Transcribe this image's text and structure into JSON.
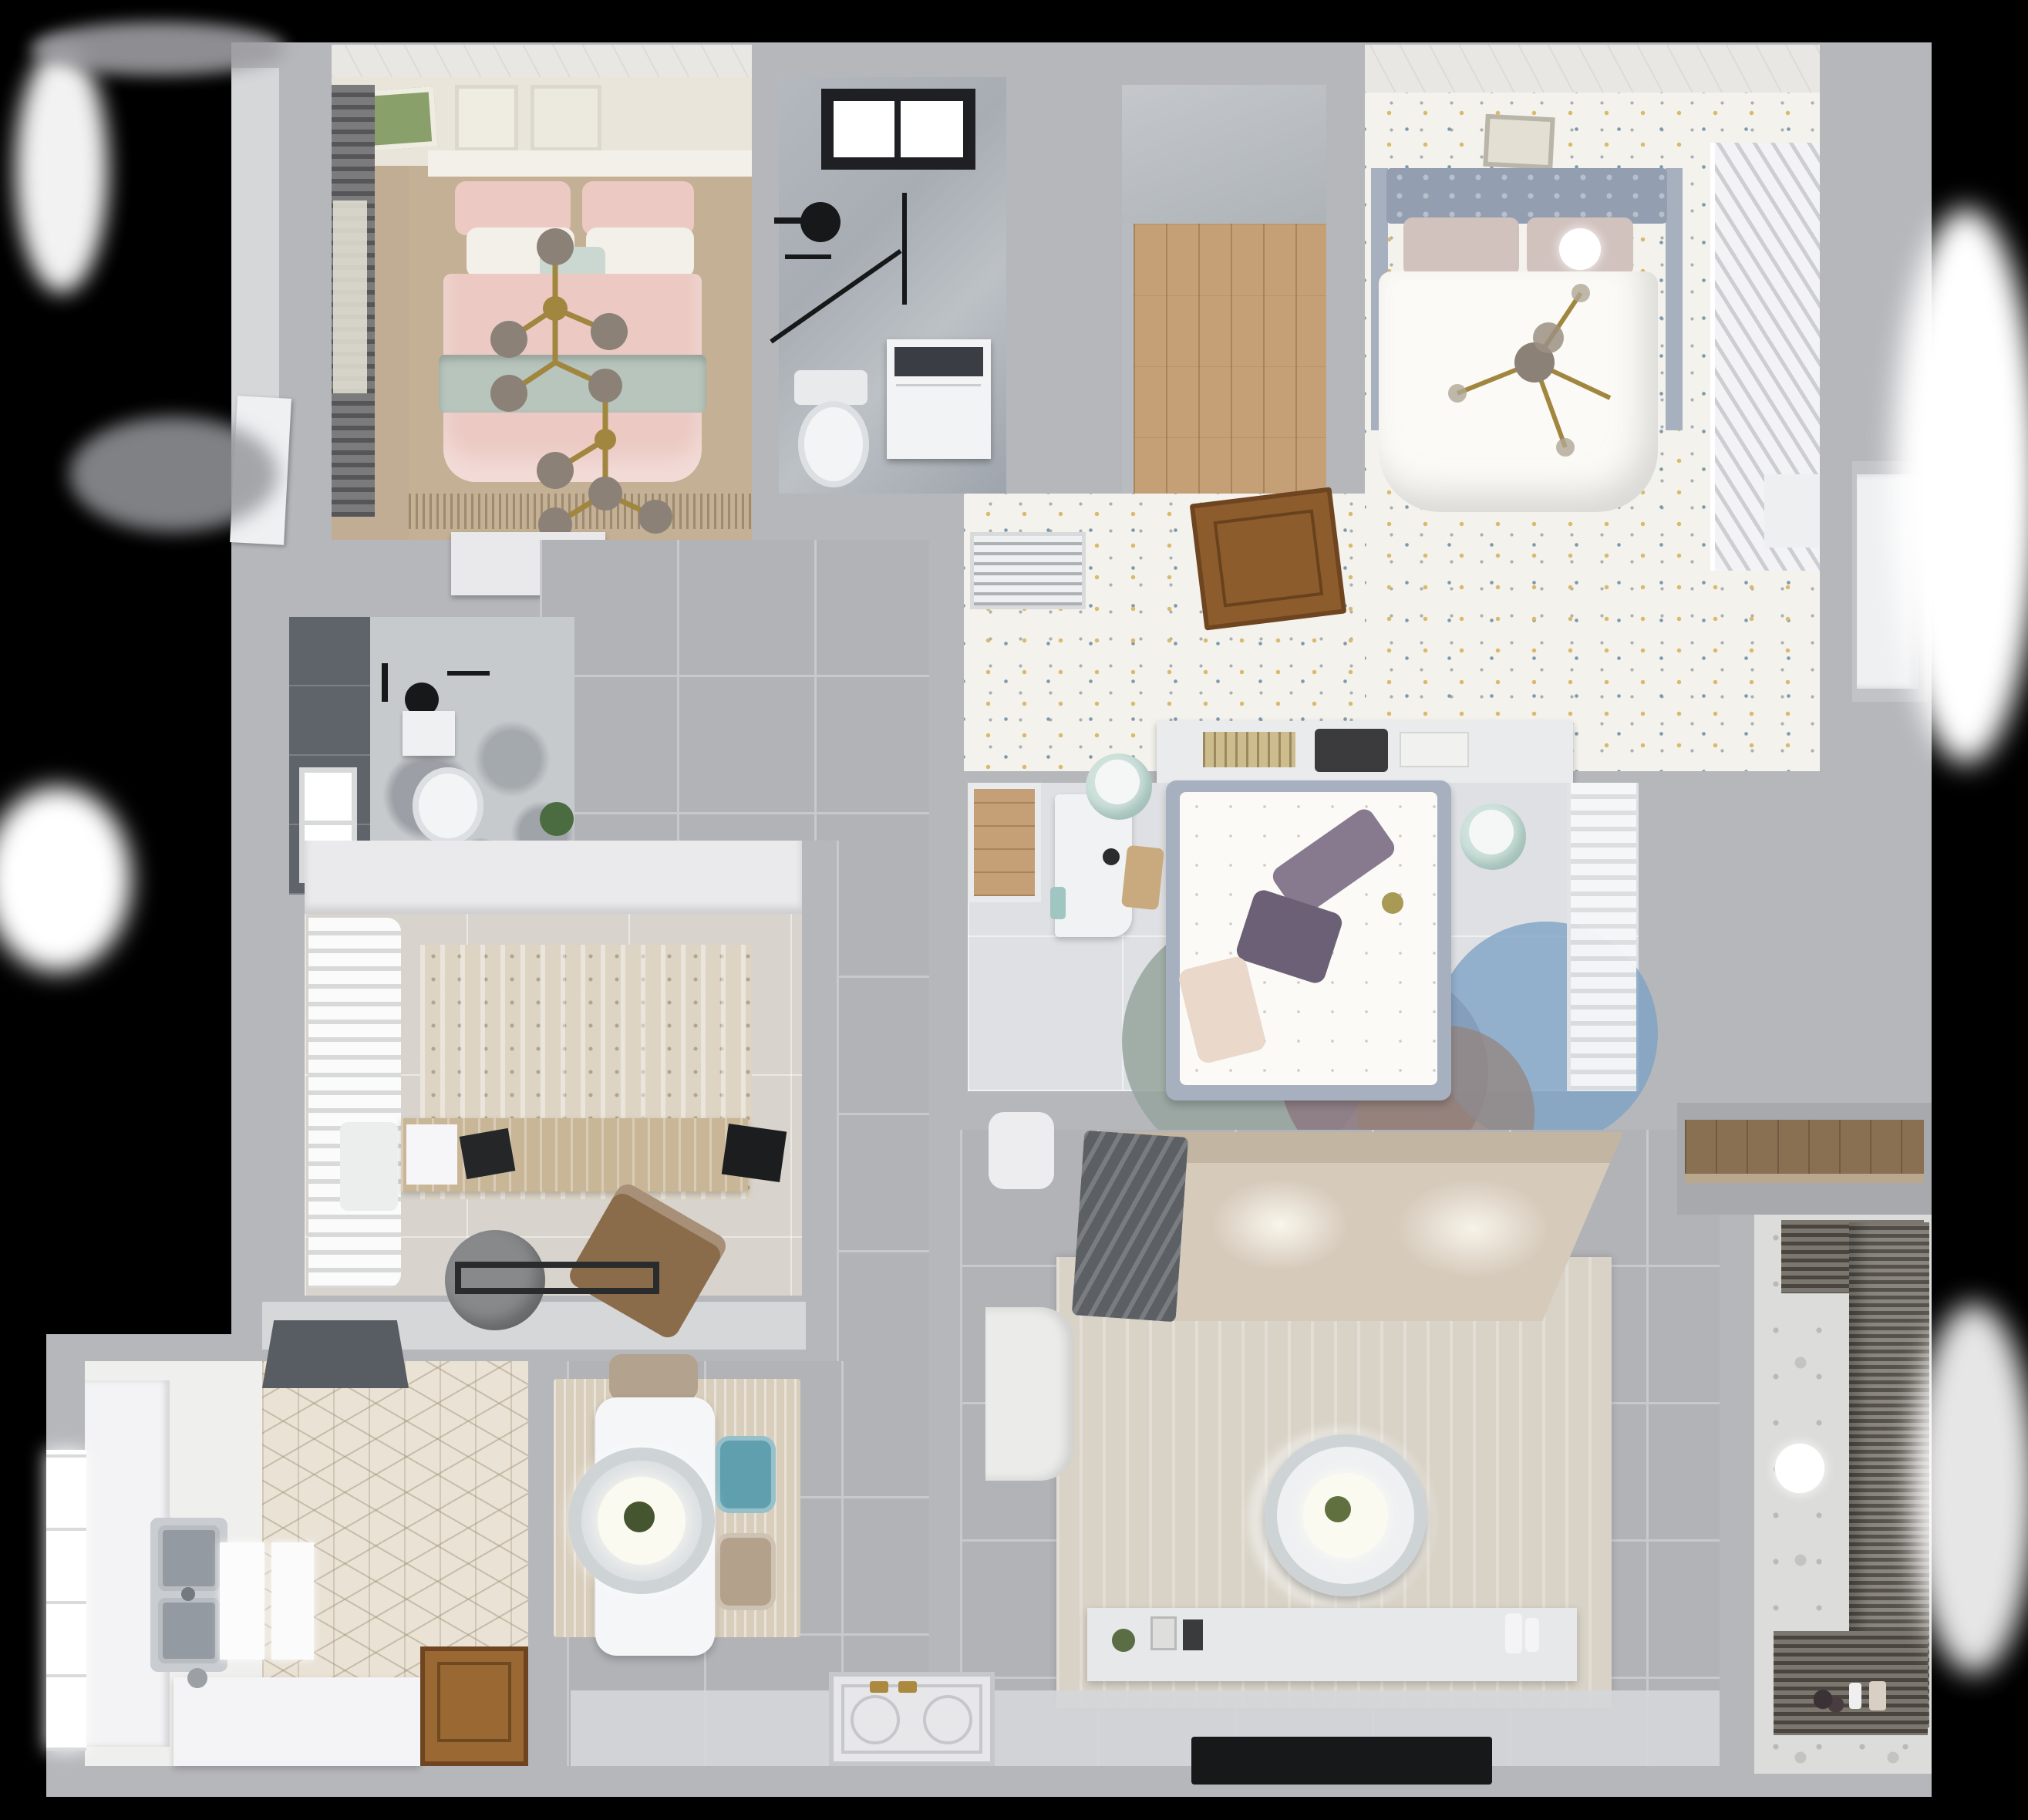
{
  "scene": {
    "title": "Top-down 3D render of an apartment floor plan",
    "type": "architectural-3d-floorplan",
    "visible_text": ""
  },
  "palette": {
    "bg": "#000000",
    "wall": "#b6b7bb",
    "wallLight": "#d6d7d9",
    "ceilingWhite": "#e8e7e3",
    "tileGray": "#b2b3b7",
    "grout": "#c8c9cd",
    "entryLight": "#d5d6d8",
    "floorTan": "#c3b095",
    "woodWall": "#c1ac94",
    "headboardWall": "#eae5db",
    "pinkBed": "#ecc9c3",
    "sageBand": "#b7c5bd",
    "whitePillow": "#f3f0ea",
    "mintPillow": "#cbd8d1",
    "gold": "#a1863f",
    "globe": "#8b8177",
    "dresserWhite": "#e9e9eb",
    "marble": "#a8adb3",
    "marbleLight": "#c7cacd",
    "black": "#17181a",
    "washerWhite": "#f2f3f5",
    "washerDark": "#3a3e44",
    "toiletWhite": "#f2f4f6",
    "closetGray": "#b8bcc1",
    "woodFloor": "#c5a077",
    "floralBase": "#f4f2ec",
    "speckYellow": "#d9b96c",
    "speckBlue": "#7e99a9",
    "speckGray": "#aab0b6",
    "headboard2": "#939eb0",
    "railGray": "#a7b0bf",
    "pillowBlush": "#d1c2be",
    "duvetWhite": "#fbfaf6",
    "louverLine": "#cdced2",
    "doorBrown": "#8d5c2d",
    "doorBrownDark": "#6e4520",
    "ventWhite": "#eef0f2",
    "shelfWhite": "#eaebed",
    "bookTan": "#cdbd8e",
    "bookDark": "#3b3b3e",
    "floor3": "#dfe0e3",
    "mintStool": "#cfe2dc",
    "deskWhite": "#f1f2f4",
    "chairTan": "#c9aa7e",
    "pillowPurple1": "#887a8e",
    "pillowPurple2": "#6c6076",
    "blushPillow": "#ead8ca",
    "rugTeal": "#96a59e",
    "rugMauve": "#8c7680",
    "rugBlue": "#7ea3c6",
    "curtainWhite": "#f2f3f5",
    "officeFloor": "#d8d4cd",
    "cabinetWhite": "#eaeaec",
    "rugOffice": "#ddd4c4",
    "deskWood": "#c9b697",
    "chairGray": "#87898b",
    "loungeBrown": "#8a6b4a",
    "sofaBeige": "#d6cabb",
    "sofaDark": "#c2b5a2",
    "throwGray": "#5c6064",
    "rugBeige": "#d9d3c7",
    "tableWhite": "#f5f6f8",
    "ringGray": "#ced3d6",
    "glowWarm": "#fbfaf0",
    "plantGreen": "#5d7747",
    "consoleWhite": "#e7e8ea",
    "rugDining": "#d9cebc",
    "chairTeal": "#5f9fae",
    "chairTanD": "#b4a18b",
    "hexBase": "#e9e2d5",
    "hexLine": "rgba(160,143,115,.45)",
    "counterWhite": "#f3f3f5",
    "steel": "#c9ccd0",
    "steelDark": "#949aa1",
    "hoodGray": "#585d63",
    "doorKitchen": "#9a6832",
    "windowWhite": "#ffffff",
    "darkTile": "#5f646b",
    "balconyFloor": "#dcdcda",
    "radDark": "#4a463f",
    "radLight": "#7c776e",
    "shelfWood": "#8a7052",
    "matWhite": "#e7e7e9",
    "matLine": "#c6c7cb"
  },
  "rooms": [
    {
      "name": "bedroom-pink",
      "label": "bedroom with pink bedding",
      "furniture": [
        "double-bed",
        "pink-pillows",
        "sage-runner",
        "gold-branch-chandelier",
        "wall-art-frames",
        "roman-blind",
        "dresser",
        "tan-carpet"
      ]
    },
    {
      "name": "bathroom-top",
      "label": "bathroom with skylight",
      "furniture": [
        "skylight",
        "black-frame-shower",
        "rain-shower-head",
        "washing-machine",
        "toilet"
      ]
    },
    {
      "name": "closet-room",
      "label": "walk-in closet",
      "furniture": [
        "wood-plank-floor"
      ]
    },
    {
      "name": "bedroom-main",
      "label": "bedroom with white bed",
      "furniture": [
        "tufted-headboard",
        "double-bed",
        "ceiling-fan",
        "ball-lamp",
        "louver-wardrobe",
        "wall-art",
        "speckled-floor"
      ]
    },
    {
      "name": "bedroom-hall",
      "label": "bedroom entry hall",
      "furniture": [
        "ac-vent",
        "open-wood-door",
        "plant",
        "headboard-shelf-books"
      ]
    },
    {
      "name": "bedroom-middle",
      "label": "middle bedroom",
      "furniture": [
        "bed-floral-duvet",
        "purple-pillows",
        "white-desk",
        "wood-chair",
        "mint-stools",
        "circle-rug-teal-mauve-blue",
        "sheer-curtain-wardrobe",
        "wood-inset-floor"
      ]
    },
    {
      "name": "shower-room-left",
      "label": "small shower room",
      "furniture": [
        "dark-tile-wall",
        "window",
        "shower-head",
        "toilet",
        "plant",
        "paper-shelf"
      ]
    },
    {
      "name": "study",
      "label": "study / office",
      "furniture": [
        "wood-desk",
        "monitor",
        "laptop",
        "gray-swivel-chair",
        "brown-lounge-chair",
        "distressed-rug",
        "white-curtains",
        "cabinet-band",
        "floor-mat"
      ]
    },
    {
      "name": "kitchen",
      "label": "kitchen",
      "furniture": [
        "range-hood",
        "double-stainless-sink",
        "counter",
        "white-island",
        "serving-trays",
        "hex-tile-floor",
        "wood-door",
        "window"
      ]
    },
    {
      "name": "dining",
      "label": "dining area",
      "furniture": [
        "white-table",
        "round-pendant-lamp",
        "teal-chair",
        "tan-chair",
        "head-chair",
        "striated-rug"
      ]
    },
    {
      "name": "hallway",
      "label": "hallway",
      "furniture": [
        "gray-floor-tiles",
        "entrance-mat",
        "gold-handles"
      ]
    },
    {
      "name": "living-room",
      "label": "living room",
      "furniture": [
        "sectional-sofa",
        "gray-throw",
        "armchair",
        "side-stool",
        "round-coffee-table",
        "beige-rug",
        "tv-console",
        "tv-panel",
        "decor-plant",
        "picture-frames",
        "vases"
      ]
    },
    {
      "name": "balcony",
      "label": "balcony / laundry",
      "furniture": [
        "drying-rack-blinds",
        "ball-lamp",
        "patterned-tile-floor",
        "toys",
        "bottles"
      ]
    },
    {
      "name": "storage-niche",
      "label": "storage niche",
      "furniture": [
        "wood-shelf"
      ]
    },
    {
      "name": "right-hall",
      "label": "right hall niche",
      "furniture": [
        "white-door"
      ]
    }
  ]
}
